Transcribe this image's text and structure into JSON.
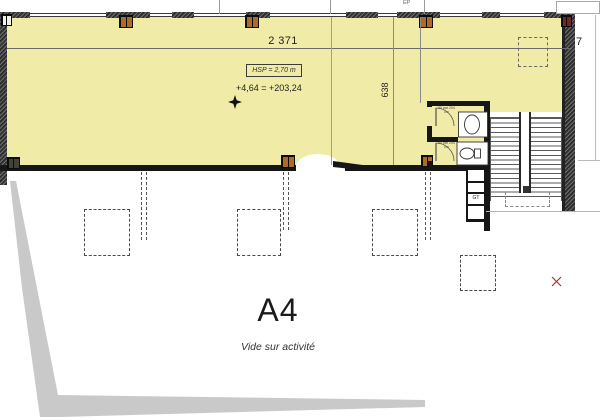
{
  "drawing": {
    "zone": {
      "code": "A4",
      "note": "Vide sur activité"
    },
    "dimensions": {
      "width": "2 371",
      "depth": "638",
      "right": "7"
    },
    "annotations": {
      "ceiling_height": "HSP = 2,70 m",
      "level": "+4,64 = +203,24",
      "duct": "GT",
      "rainwater": "EP",
      "door_upper": "90 par 204 cm",
      "door_lower": "90 par 204 cm"
    },
    "colors": {
      "floor_fill": "#f0eba6",
      "wall": "#161616",
      "wall_hatch": "#4b4b4b",
      "site_shadow": "#c9c9c9",
      "post_pane": "#b06a28",
      "marker_red": "#b03030"
    }
  }
}
